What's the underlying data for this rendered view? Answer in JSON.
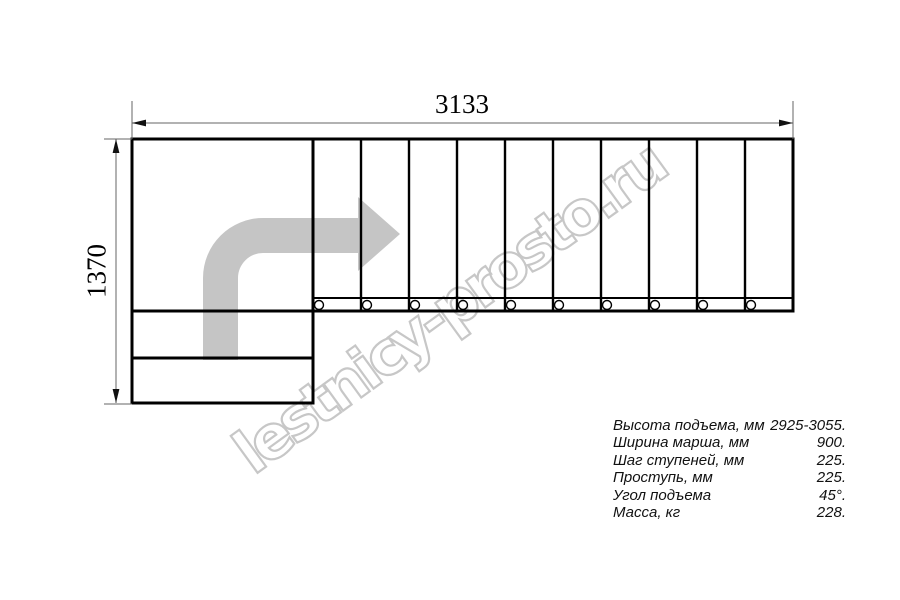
{
  "dimensions": {
    "width_label": "3133",
    "height_label": "1370"
  },
  "watermark": {
    "text": "lestnicy-prosto.ru"
  },
  "specs": {
    "rows": [
      {
        "label": "Высота подъема, мм",
        "value": "2925-3055."
      },
      {
        "label": "Ширина марша, мм",
        "value": "900."
      },
      {
        "label": "Шаг ступеней, мм",
        "value": "225."
      },
      {
        "label": "Проступь, мм",
        "value": "225."
      },
      {
        "label": "Угол подъема",
        "value": "45°."
      },
      {
        "label": "Масса, кг",
        "value": "228."
      }
    ]
  },
  "colors": {
    "background": "#ffffff",
    "drawing_line": "#000000",
    "dimension_line": "#666666",
    "direction_arrow": "#c5c5c5",
    "watermark": "#c7c7c7"
  }
}
